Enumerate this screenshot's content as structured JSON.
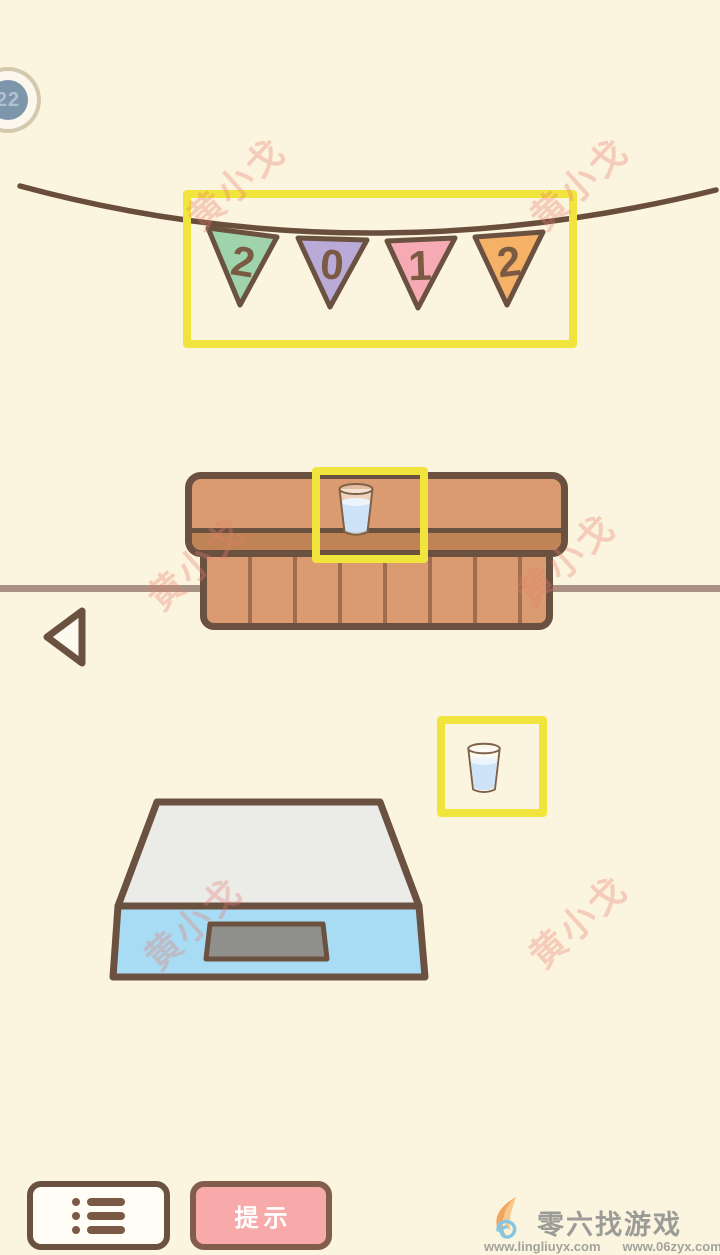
{
  "colors": {
    "background": "#fbf4de",
    "outline_brown": "#6b5140",
    "highlight_yellow": "#f1e43c",
    "cabinet_brown": "#d99b6f",
    "cabinet_strip_brown": "#bf8355",
    "scale_top_gray": "#ebebe8",
    "scale_front_blue": "#a8dbf4",
    "scale_display_gray": "#8f8f8c",
    "glass_liquid_blue": "#cde4f8",
    "hint_button_pink": "#f8a9a9",
    "watermark_red": "#e87d6e",
    "badge_disc_blue": "#7e96ac"
  },
  "level_badge": {
    "label": "22"
  },
  "banner": {
    "flags": [
      {
        "digit": "2",
        "color": "#9fd3ab"
      },
      {
        "digit": "0",
        "color": "#b9aad7"
      },
      {
        "digit": "1",
        "color": "#f6aab4"
      },
      {
        "digit": "2",
        "color": "#f5b267"
      }
    ]
  },
  "toolbar": {
    "hint_label": "提示"
  },
  "watermark": {
    "text": "黄小戈"
  },
  "footer": {
    "site_name": "零六找游戏",
    "url_left": "www.lingliuyx.com",
    "url_right": "www.06zyx.com"
  }
}
